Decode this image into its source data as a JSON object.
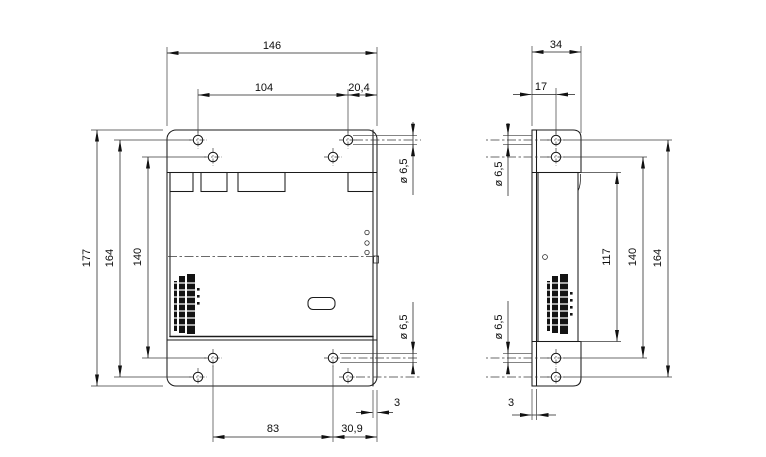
{
  "views": {
    "front": {
      "dims": {
        "width": "146",
        "hole_span_x": "104",
        "hole_to_edge_x": "20,4",
        "height": "177",
        "outer_span_y": "164",
        "inner_span_y": "140",
        "hole_dia_top": "ø 6,5",
        "hole_dia_bottom": "ø 6,5",
        "bottom_span": "83",
        "bottom_to_edge": "30,9",
        "edge_lip": "3"
      }
    },
    "side": {
      "dims": {
        "depth": "34",
        "hole_offset": "17",
        "hole_dia_top": "ø 6,5",
        "hole_dia_bottom": "ø 6,5",
        "body_height": "117",
        "inner_span_y": "140",
        "outer_span_y": "164",
        "plate_thickness": "3"
      }
    }
  }
}
